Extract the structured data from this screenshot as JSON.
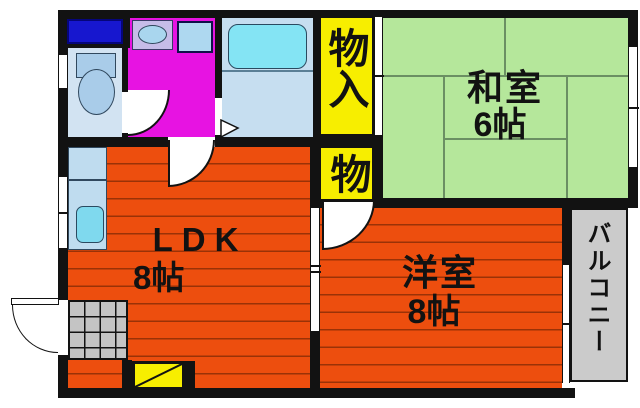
{
  "plan_title": "apartment-floor-plan",
  "rooms": {
    "ldk": {
      "label": "LDK",
      "size": "8帖"
    },
    "japanese_room": {
      "label": "和室",
      "size": "6帖"
    },
    "western_room": {
      "label": "洋室",
      "size": "8帖"
    },
    "balcony": {
      "label": "バルコニー"
    },
    "storage_large": {
      "label": "物入"
    },
    "storage_small": {
      "label": "物"
    }
  },
  "colors": {
    "wall_black": "#121212",
    "wood_floor_orange": "#ed4e0e",
    "wood_floor_line": "#9a3207",
    "tatami_green": "#b5e79b",
    "tatami_line": "#6b8f63",
    "storage_yellow": "#f7ee00",
    "washroom_magenta": "#e713e2",
    "bathroom_blue": "#c6def0",
    "toilet_room_blue": "#d2e3f2",
    "fixture_blue": "#a9cce9",
    "bathtub_cyan": "#84e4f4",
    "window_navy": "#1717cf",
    "balcony_gray": "#cbcbcb",
    "entry_tile_gray": "#c4c4c4"
  }
}
